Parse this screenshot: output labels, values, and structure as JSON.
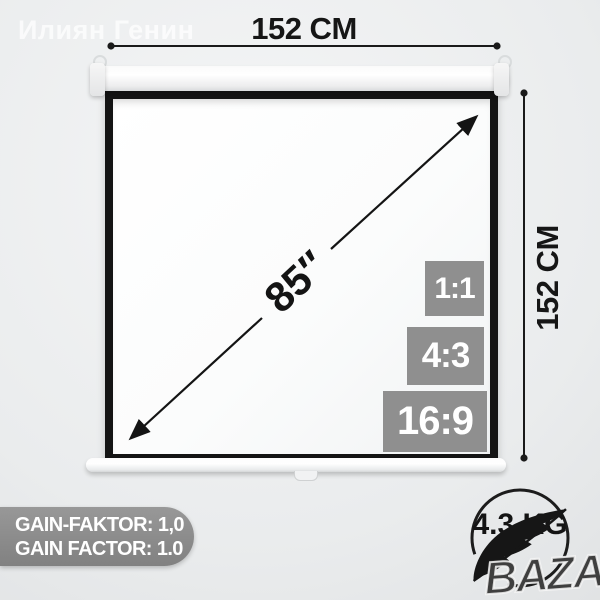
{
  "watermarks": {
    "seller": "Илиян Генин",
    "marketplace": "BAZAR"
  },
  "dimensions": {
    "width": {
      "label": "152 CM"
    },
    "height": {
      "label": "152 CM"
    },
    "diagonal": {
      "label": "85″"
    }
  },
  "aspect_ratios": [
    {
      "label": "1:1"
    },
    {
      "label": "4:3"
    },
    {
      "label": "16:9"
    }
  ],
  "specs": {
    "gain_line1": "GAIN-FAKTOR: 1,0",
    "gain_line2": "GAIN FACTOR: 1.0",
    "weight": "4.3 KG"
  },
  "icons": {
    "feather": "feather-icon (lightweight)"
  },
  "colors": {
    "badge_gray": "#8f8f8f",
    "pill_gray": "#8a8a8a",
    "line_black": "#1a1a1a",
    "frame_black": "#141414",
    "screen_white": "#fbfcfc",
    "background_gray": "#e8eaeb"
  }
}
